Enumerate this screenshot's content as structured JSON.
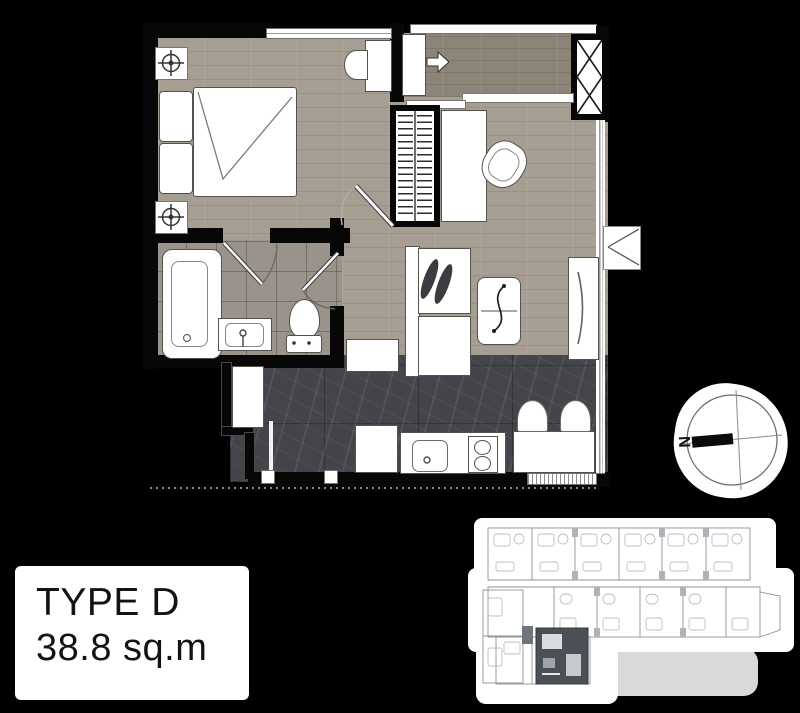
{
  "theme": {
    "bg": "#000000",
    "wood": "#a69d93",
    "wood-dark": "#8d8478",
    "tile": "#9a938b",
    "marble": "#44454a",
    "wall": "#070707",
    "fixture": "#ffffff",
    "fixture-line": "#55514c",
    "card-bg": "#ffffff",
    "card-text": "#131315",
    "keyplan-line": "#8e949a",
    "keyplan-highlight": "#4b4f56"
  },
  "title_card": {
    "type_label": "TYPE D",
    "area_label": "38.8 sq.m"
  },
  "compass": {
    "north_label": "N"
  },
  "floorplan": {
    "rooms": [
      "bedroom",
      "bathroom",
      "entrance-hall",
      "study-nook",
      "living-area",
      "kitchen"
    ],
    "furniture_icons": [
      "ceiling-light",
      "ceiling-light",
      "double-bed",
      "wardrobe",
      "desk",
      "chair",
      "washbasin",
      "entrance-door",
      "sliding-door",
      "service-shaft",
      "bathtub",
      "vanity-sink",
      "toilet",
      "sofa",
      "leaf-cushions",
      "side-table",
      "tv-cabinet",
      "hall-cabinet",
      "washer-cabinet",
      "kitchen-cabinet",
      "kitchen-sink",
      "two-burner-stove",
      "bar-counter",
      "bar-stool",
      "bar-stool",
      "air-conditioner"
    ]
  }
}
